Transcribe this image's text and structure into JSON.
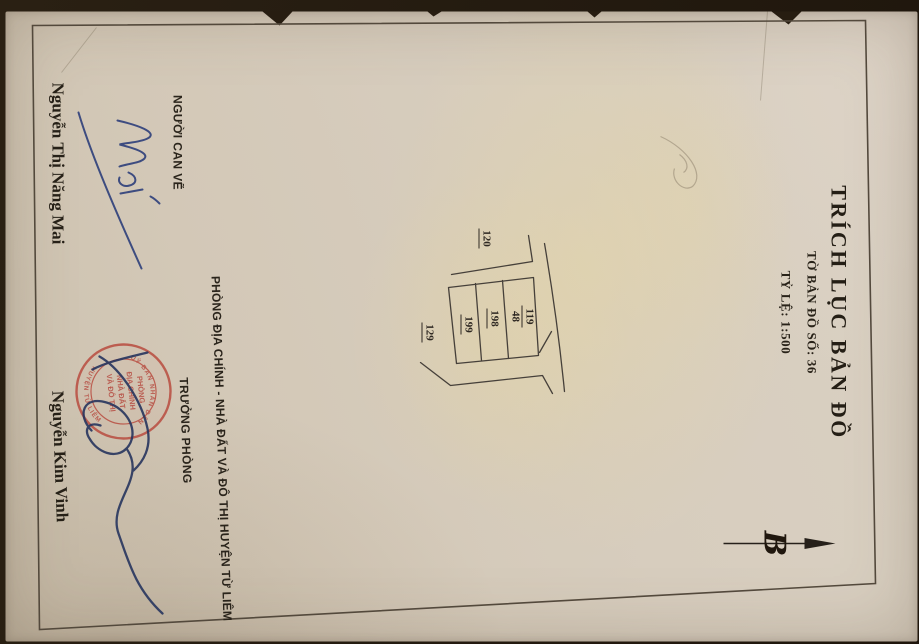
{
  "document": {
    "title": "TRÍCH LỤC BẢN ĐỒ",
    "sheet_no_line": "TỜ BẢN ĐỒ SỐ: 36",
    "scale_line": "TỶ LỆ: 1:500",
    "north_letter": "B"
  },
  "map_sketch": {
    "parcel_fraction": {
      "numerator": "119",
      "denominator": "48"
    },
    "parcel_2": "198",
    "parcel_3": "199",
    "neighbor_left": "120",
    "neighbor_below": "129"
  },
  "drafter_block": {
    "role_label": "NGƯỜI CAN VẼ",
    "signature_name": "Mai",
    "full_name": "Nguyễn Thị Năng Mai"
  },
  "office_block": {
    "department_line": "PHÒNG ĐỊA CHÍNH - NHÀ ĐẤT VÀ ĐÔ THỊ HUYỆN TỪ LIÊM",
    "role_label": "TRƯỞNG PHÒNG",
    "full_name": "Nguyễn Kim Vinh"
  },
  "stamp": {
    "rim_top": "UỶ BAN NHÂN DÂN",
    "rim_bottom": "HUYỆN TỪ LIÊM",
    "center_lines": [
      "PHÒNG",
      "ĐỊA CHÍNH",
      "NHÀ ĐẤT",
      "VÀ ĐÔ THỊ"
    ]
  },
  "colors": {
    "paper": "#d7cdbe",
    "ink": "#2a241c",
    "map_line": "#46403a",
    "stamp_red": "#b8473b",
    "signature_blue": "#31427c",
    "signature_navy": "#27355e",
    "scan_background": "#241b10"
  }
}
